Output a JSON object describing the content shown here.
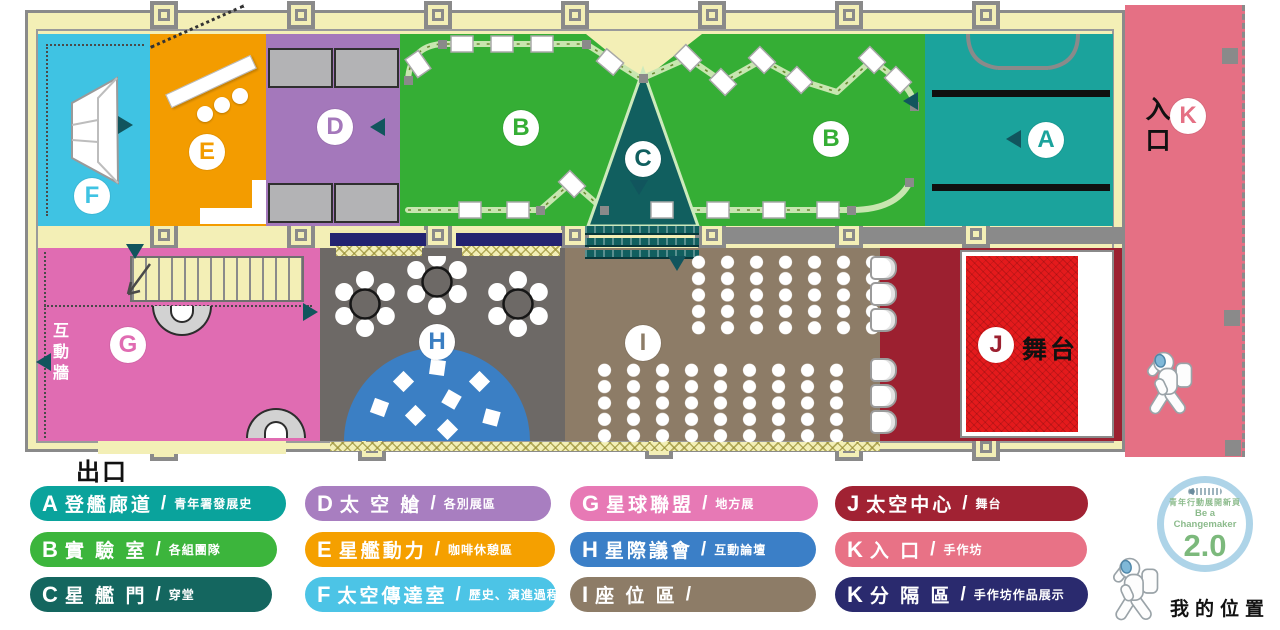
{
  "colors": {
    "zones": {
      "a": "#1ba39c",
      "b": "#35ae35",
      "c": "#115f5f",
      "d": "#a478bb",
      "e": "#f39c00",
      "f": "#3fc3e3",
      "g": "#e06cb2",
      "h_floor": "#6d6966",
      "h_letter": "#3a7ec2",
      "i": "#8d7c67",
      "j": "#9c2030",
      "k": "#e57084"
    },
    "accents": {
      "stage_red": "#e41a1c",
      "dome_blue": "#3b7fc4",
      "partition_navy": "#232370",
      "wall_cream": "#f3efb6",
      "wall_gray": "#8a8a8a",
      "truss_green": "#c8e6b0",
      "marker_teal": "#11555d"
    }
  },
  "floorplan": {
    "labels": {
      "exit": "出口",
      "entrance": "入口",
      "interactive_wall": "互動牆",
      "stage": "舞台"
    },
    "zones": {
      "a": "A",
      "b_left": "B",
      "b_right": "B",
      "c": "C",
      "d": "D",
      "e": "E",
      "f": "F",
      "g": "G",
      "h": "H",
      "i": "I",
      "j": "J",
      "k": "K"
    }
  },
  "legend": {
    "slash": "/",
    "items": [
      {
        "code": "A",
        "name": "登艦廊道",
        "sub": "青年署發展史",
        "color": "#0aa39c"
      },
      {
        "code": "B",
        "name": "實 驗 室",
        "sub": "各組團隊",
        "color": "#3cb53c"
      },
      {
        "code": "C",
        "name": "星 艦 門",
        "sub": "穿堂",
        "color": "#14665f"
      },
      {
        "code": "D",
        "name": "太 空 艙",
        "sub": "各別展區",
        "color": "#a87ec0"
      },
      {
        "code": "E",
        "name": "星艦動力",
        "sub": "咖啡休憩區",
        "color": "#f5a000"
      },
      {
        "code": "F",
        "name": "太空傳達室",
        "sub": "歷史、演進過程",
        "color": "#4cc4e6"
      },
      {
        "code": "G",
        "name": "星球聯盟",
        "sub": "地方展",
        "color": "#e779b5"
      },
      {
        "code": "H",
        "name": "星際議會",
        "sub": "互動論壇",
        "color": "#3b7fc7"
      },
      {
        "code": "I",
        "name": "座 位 區",
        "sub": "",
        "color": "#8d7c67"
      },
      {
        "code": "J",
        "name": "太空中心",
        "sub": "舞台",
        "color": "#a12233"
      },
      {
        "code": "K",
        "name": "入  口",
        "sub": "手作坊",
        "color": "#e87286"
      },
      {
        "code": "K",
        "name": "分 隔 區",
        "sub": "手作坊作品展示",
        "color": "#2a2a6e"
      }
    ]
  },
  "badge": {
    "tagline_zh": "青年行動展開新頁",
    "tagline_en": "Be a Changemaker",
    "version": "2.0"
  },
  "my_location": {
    "label": "我的位置"
  }
}
